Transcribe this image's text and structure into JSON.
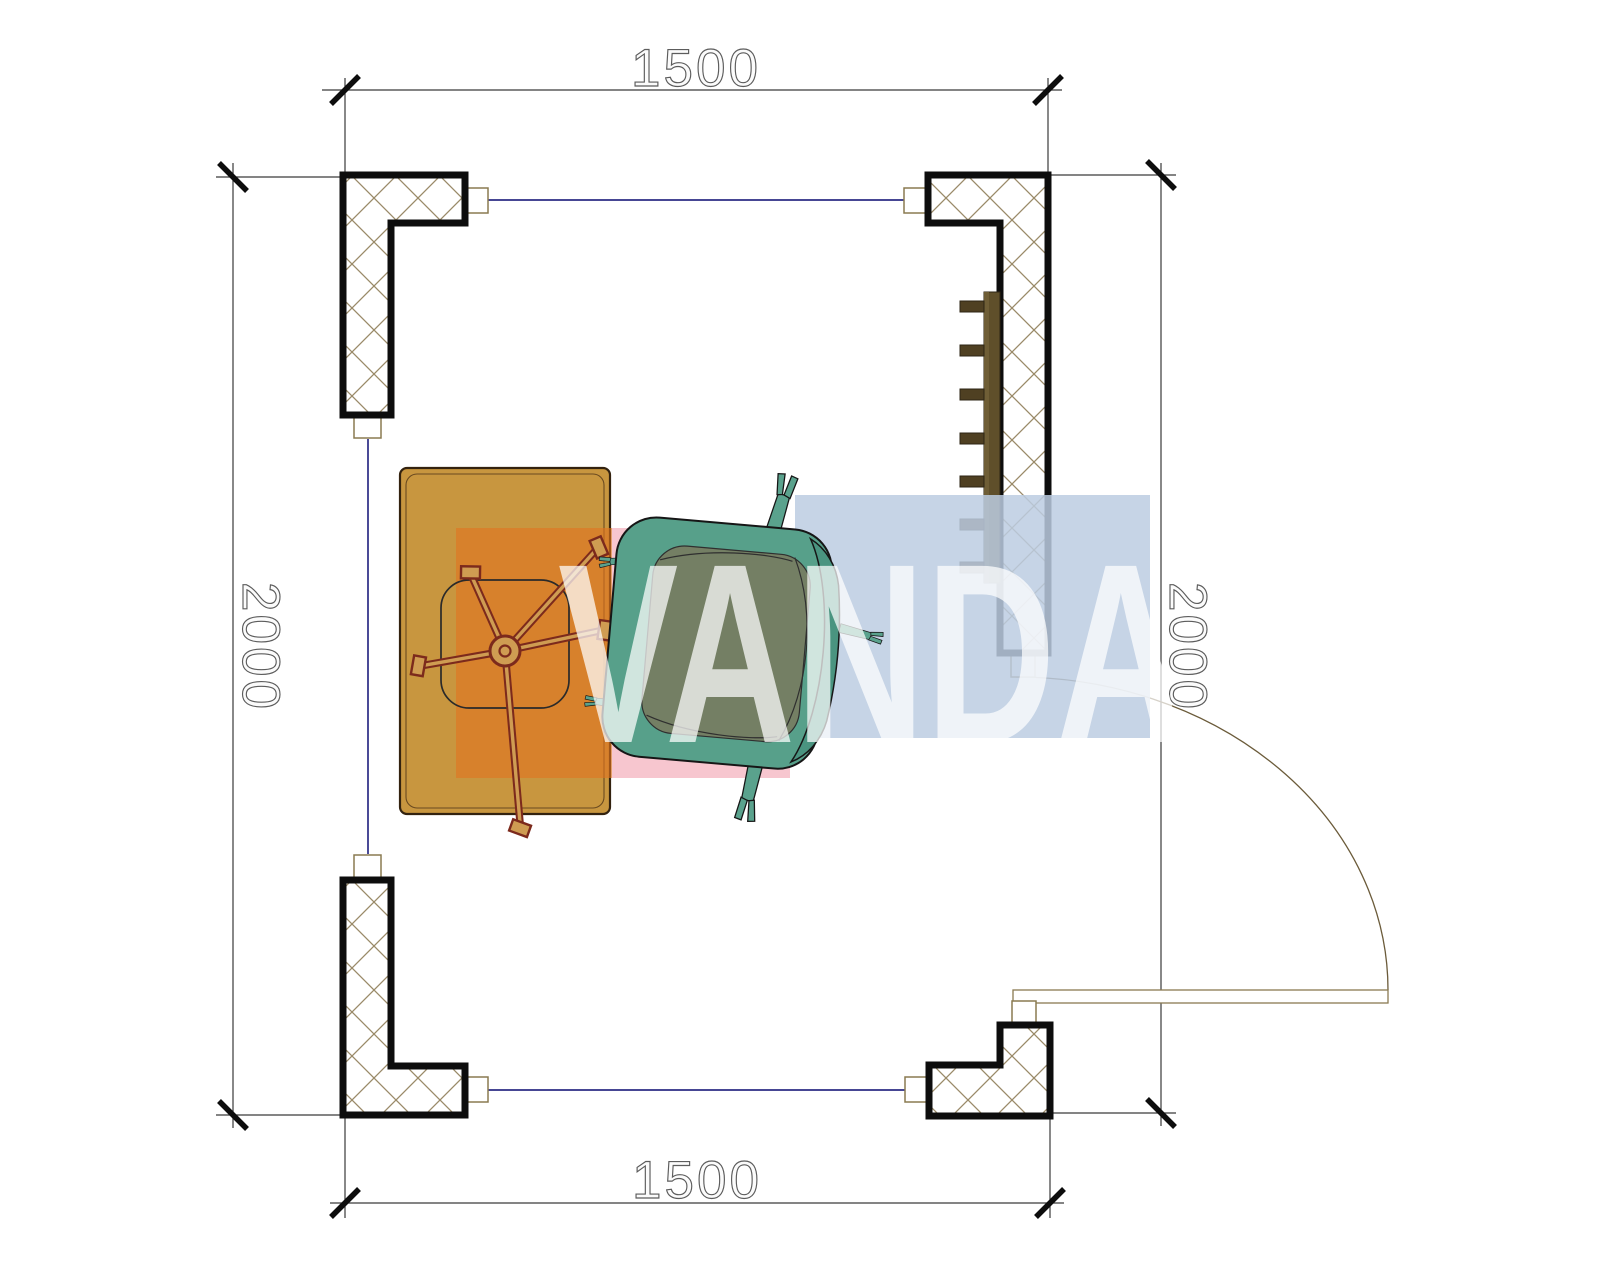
{
  "plan": {
    "title": "room-floor-plan",
    "room_width_mm": "1500",
    "room_depth_mm": "2000"
  },
  "dimensions": {
    "top": "1500",
    "bottom": "1500",
    "left": "2000",
    "right": "2000"
  },
  "watermark": {
    "text": "VANDA",
    "block_orange": "#e07420",
    "block_pink": "#f6bcc7",
    "block_blue": "#bccde2",
    "letter_color": "rgba(255,255,255,0.72)"
  },
  "colors": {
    "wall_outline": "#0d0d0d",
    "wall_hatch": "#9a8a68",
    "window_line": "#2b2b85",
    "dimension_line": "#3a3a3a",
    "connector_frame": "#8a7a50",
    "door_arc": "#6b5b3a",
    "desk_fill": "#c8963f",
    "chair_base": "#7c2a1c",
    "armchair_fill": "#57a08a",
    "armchair_cushion": "#747f64",
    "armchair_back": "#4a9480",
    "radiator_fill": "#5f4f2a",
    "radiator_fin": "#4f4022"
  },
  "elements": {
    "columns": "corner-column",
    "window": "window-line",
    "door": "door-leaf-and-swing",
    "desk": "desk",
    "task_chair": "office-chair-star-base",
    "armchair": "armchair-top-view",
    "radiator": "wall-radiator"
  }
}
